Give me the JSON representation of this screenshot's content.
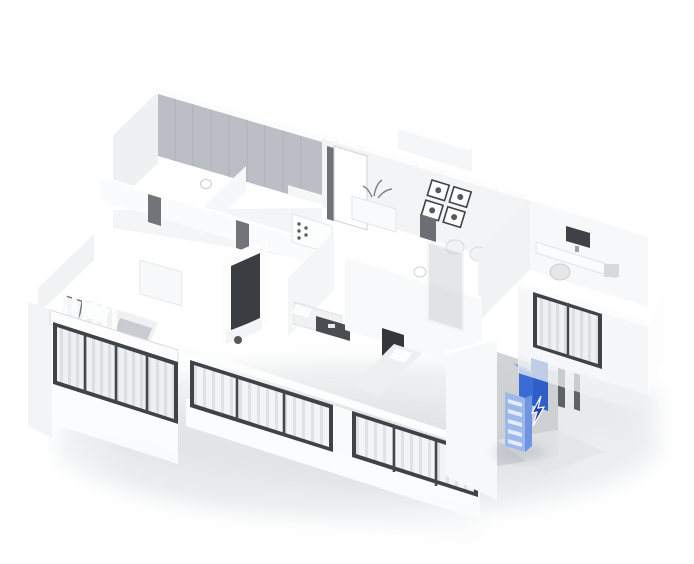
{
  "scene": {
    "description": "3D axonometric white floor-plan rendering of an apartment; one entrance shoe cabinet is highlighted in blue with a small pointer beside it",
    "background": "#ffffff"
  },
  "colors": {
    "accent": "#3b68d0",
    "cabinet_back": "#2f5ec9",
    "cabinet_mid": "#3b6bd4",
    "cabinet_top": "#7ba0ee",
    "cabinet_rack": "#9db9ec",
    "cabinet_rack_side": "#6f94e2",
    "cursor": "#1f3fae",
    "glass_wall": "#b7bcc2",
    "window_frame": "#3f4347",
    "wall_white": "#fafbfc",
    "wall_shade": "#eef0f2",
    "shadow": "#dfe1e3"
  },
  "rooms": [
    "left-balcony",
    "master-bedroom",
    "living-room",
    "kitchen",
    "hallway",
    "dining-area",
    "entry",
    "storage-closet",
    "bathroom",
    "second-bedroom",
    "study",
    "right-wing",
    "entrance-nook"
  ],
  "highlight": {
    "item": "entrance-cabinet"
  }
}
